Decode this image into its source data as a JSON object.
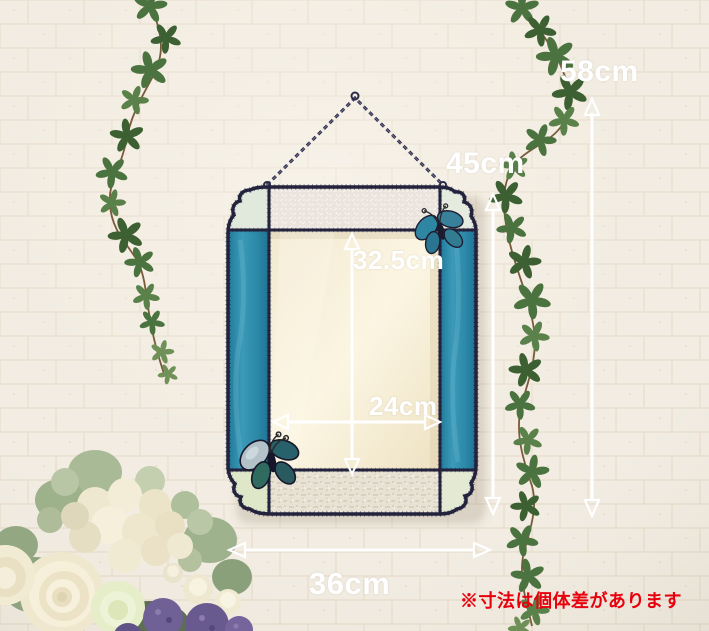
{
  "dimensions": {
    "total_height": "58cm",
    "frame_height": "45cm",
    "glass_height": "32.5cm",
    "glass_width": "24cm",
    "frame_width": "36cm"
  },
  "note": {
    "text": "※寸法は個体差があります"
  },
  "colors": {
    "teal_glass": "#2f8fae",
    "lead_frame": "#23233d",
    "wall_cream": "#f1ece3",
    "annotation_white": "#ffffff",
    "note_red": "#e8000d"
  },
  "icons": {
    "total_height_arrow": "vertical-double-arrow",
    "frame_height_arrow": "vertical-double-arrow",
    "glass_height_arrow": "vertical-double-arrow",
    "glass_width_arrow": "horizontal-double-arrow",
    "frame_width_arrow": "horizontal-double-arrow"
  }
}
